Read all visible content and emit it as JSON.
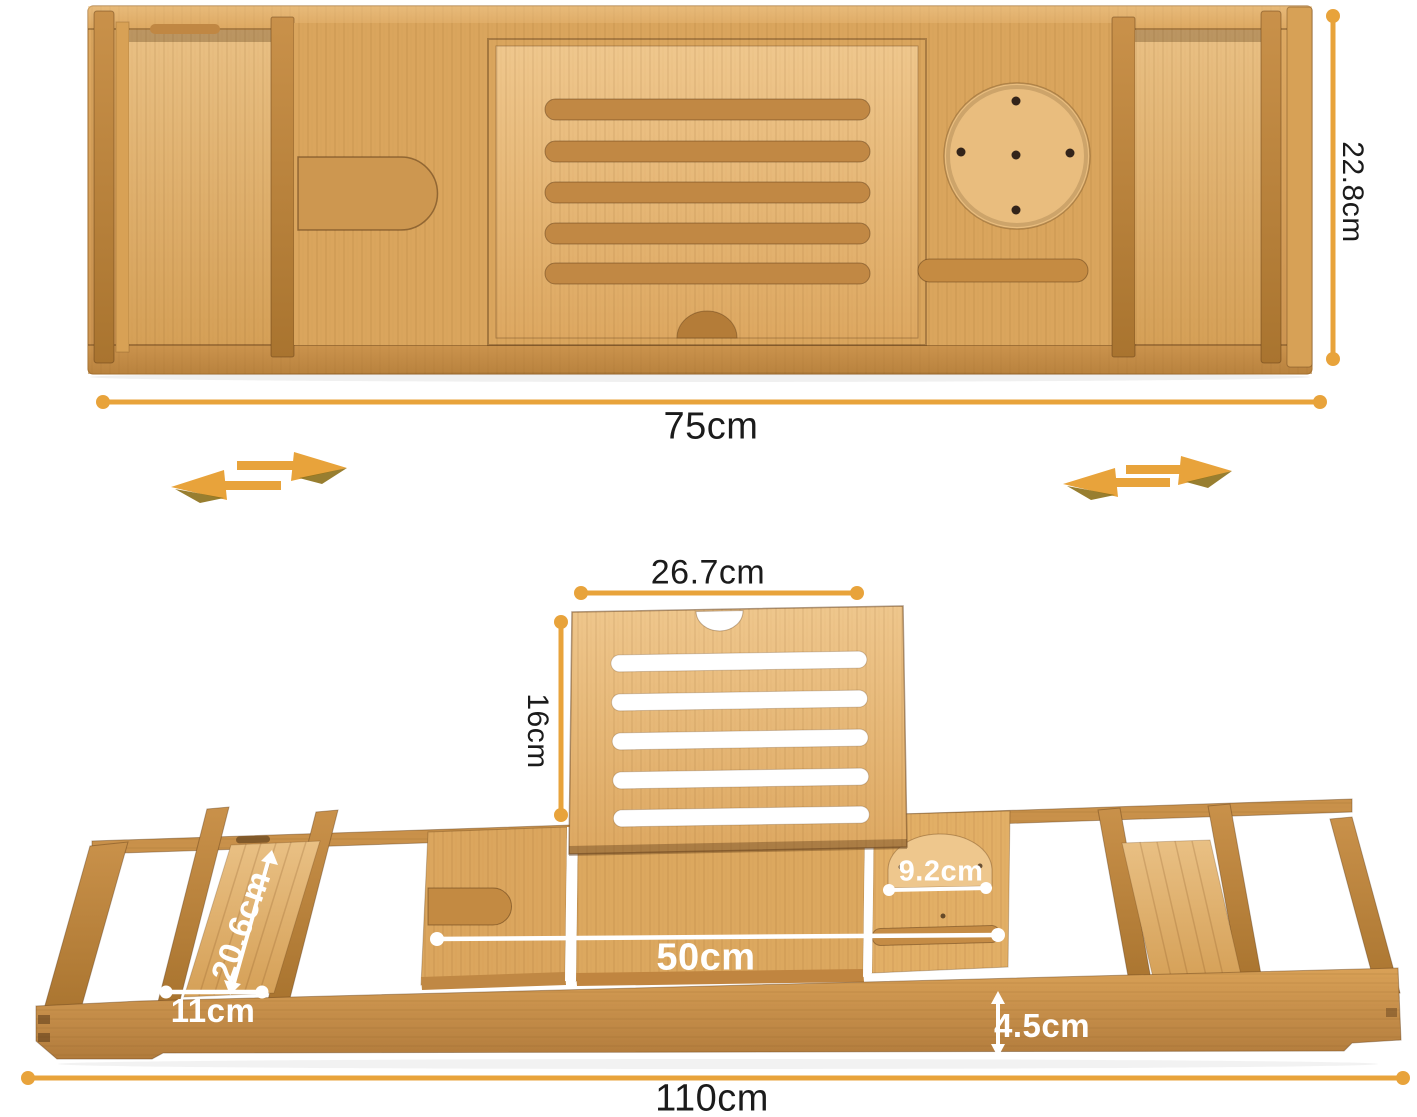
{
  "diagram": {
    "dims": {
      "top_width": "75cm",
      "top_depth": "22.8cm",
      "stand_width": "26.7cm",
      "stand_height": "16cm",
      "side_tray_length": "20.6cm",
      "side_tray_width": "11cm",
      "center_width": "50cm",
      "cup_recess": "9.2cm",
      "rail_height": "4.5cm",
      "total_width": "110cm"
    },
    "icons": {
      "left_extend": "slide-extend-arrows-icon",
      "right_extend": "slide-extend-arrows-icon"
    },
    "colors": {
      "dimension_accent": "#E8A33B",
      "dimension_white": "#FFFFFF",
      "label_text": "#1B1B1B",
      "bamboo_light": "#EFC78D",
      "bamboo_mid": "#D9A45C",
      "bamboo_dark": "#A9742F",
      "background": "#FFFFFF"
    }
  }
}
